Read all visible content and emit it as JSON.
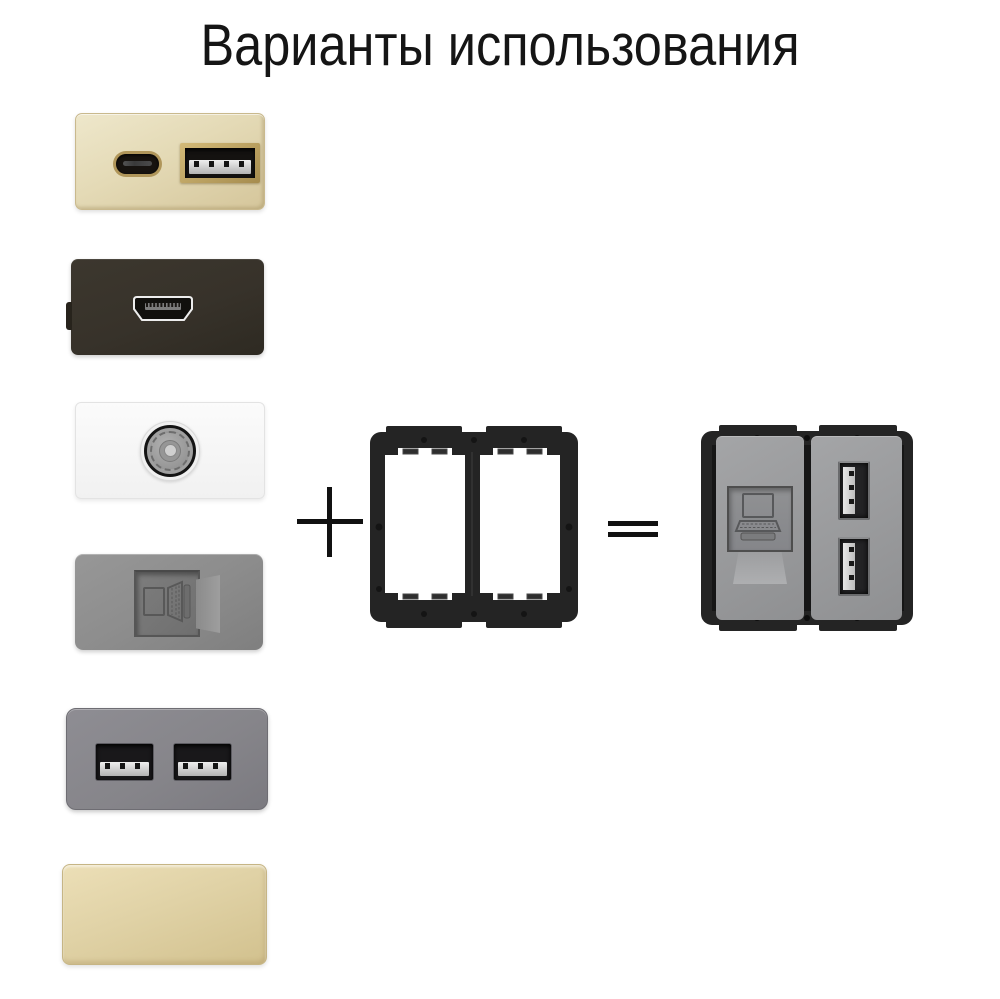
{
  "title": "Варианты использования",
  "operators": {
    "plus": "+",
    "equals": "="
  },
  "modules": [
    {
      "name": "usb-c-and-usb-a-champagne-module",
      "plate_color": "#e9e1c2"
    },
    {
      "name": "hdmi-black-module",
      "plate_color": "#37322a"
    },
    {
      "name": "tv-antenna-white-module",
      "plate_color": "#f8f8f8"
    },
    {
      "name": "ethernet-rj45-gray-module",
      "plate_color": "#8d8d8d"
    },
    {
      "name": "dual-usb-a-graphite-module",
      "plate_color": "#86858a"
    },
    {
      "name": "blank-champagne-module",
      "plate_color": "#d8c99c"
    }
  ],
  "frame": {
    "name": "two-gang-black-mounting-frame",
    "color": "#242424"
  },
  "result": {
    "name": "assembled-frame-with-rj45-and-dual-usb-modules",
    "module_color": "#9b9c9e"
  },
  "colors": {
    "title": "#151515",
    "operator": "#111111",
    "background": "#ffffff",
    "champagne_light": "#eee7cb",
    "champagne_dark": "#d5c69b",
    "gold_trim": "#b0965a",
    "hdmi_plate": "#37322a",
    "white_plate": "#f8f8f8",
    "gray_plate": "#8d8d8d",
    "graphite_plate": "#86858a",
    "blank_light": "#ecdfb7",
    "blank_dark": "#d2c18e",
    "frame_black": "#242424",
    "result_module_light": "#a4a5a7",
    "result_module_dark": "#8f9092"
  }
}
